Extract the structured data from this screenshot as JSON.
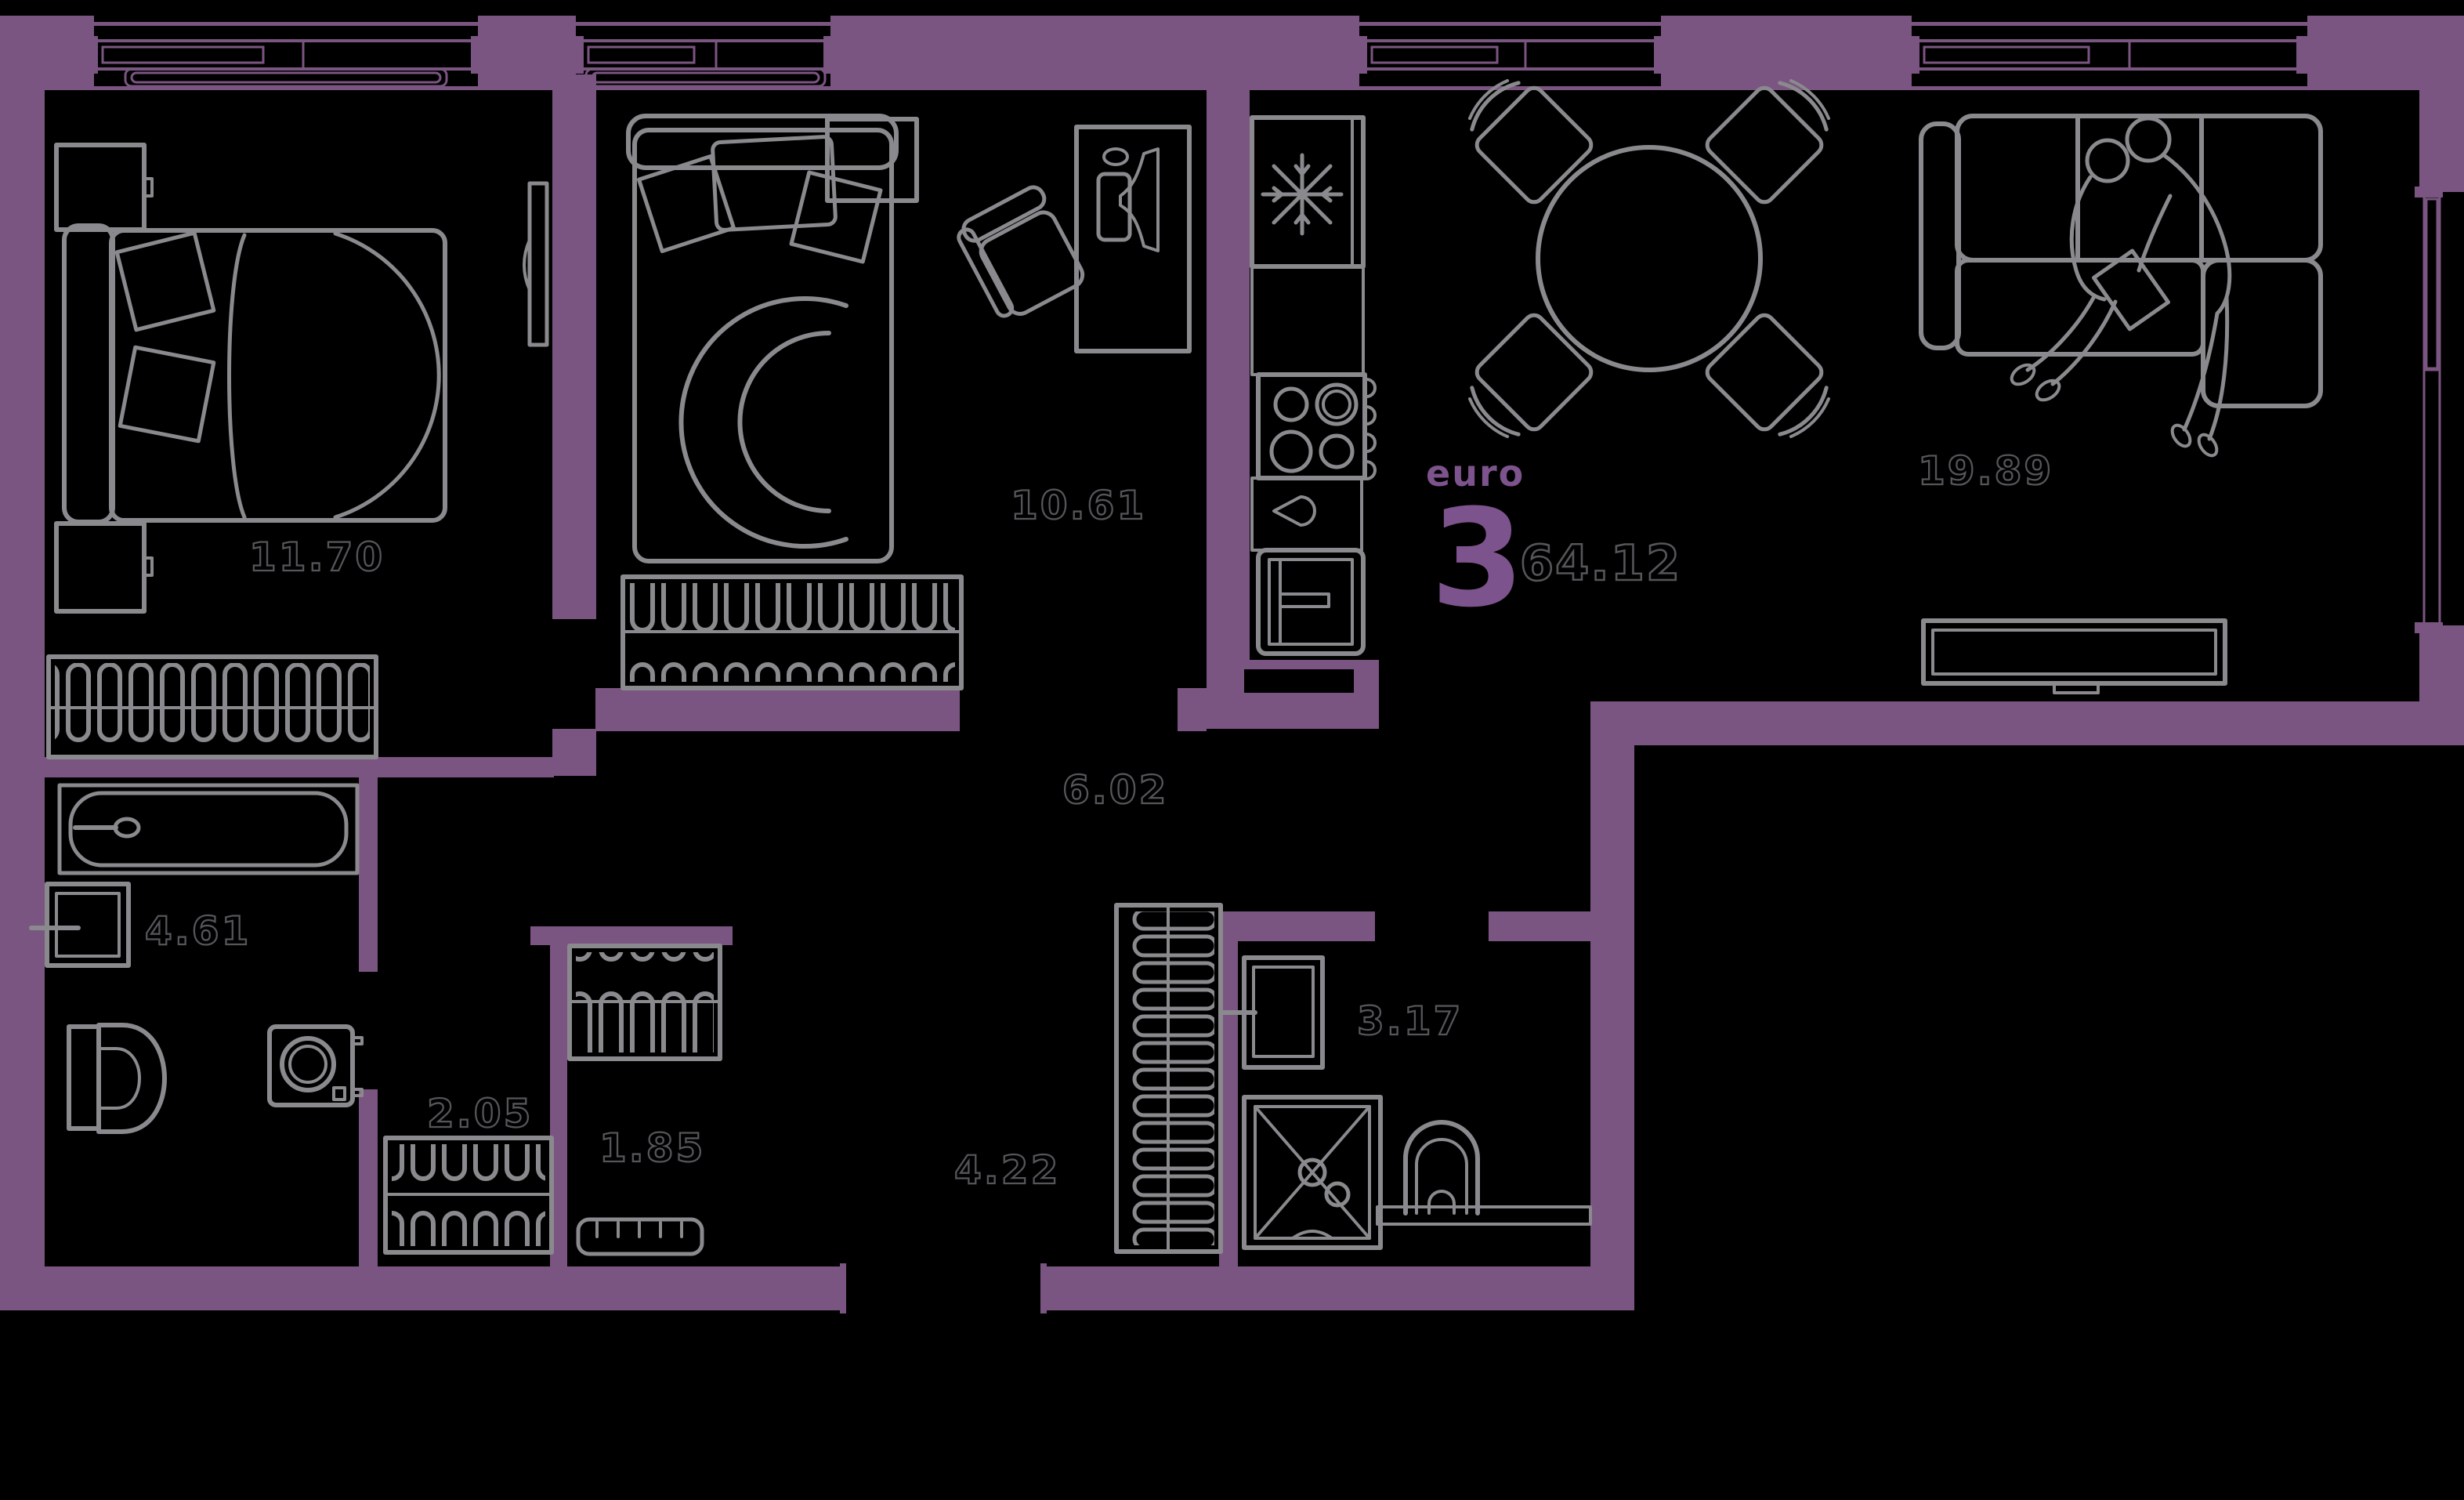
{
  "summary": {
    "type_label": "euro",
    "rooms_count": "3",
    "total_area": "64.12"
  },
  "areas": {
    "bedroom1": "11.70",
    "bedroom2": "10.61",
    "living": "19.89",
    "corridor": "6.02",
    "bathroom": "4.61",
    "closet": "2.05",
    "wardrobe": "1.85",
    "hallway": "4.22",
    "shower": "3.17"
  },
  "colors": {
    "wall": "#7b5581",
    "brand": "#7c538c",
    "furniture": "#8a8a8e",
    "label": "#55555a",
    "background": "#000000"
  }
}
